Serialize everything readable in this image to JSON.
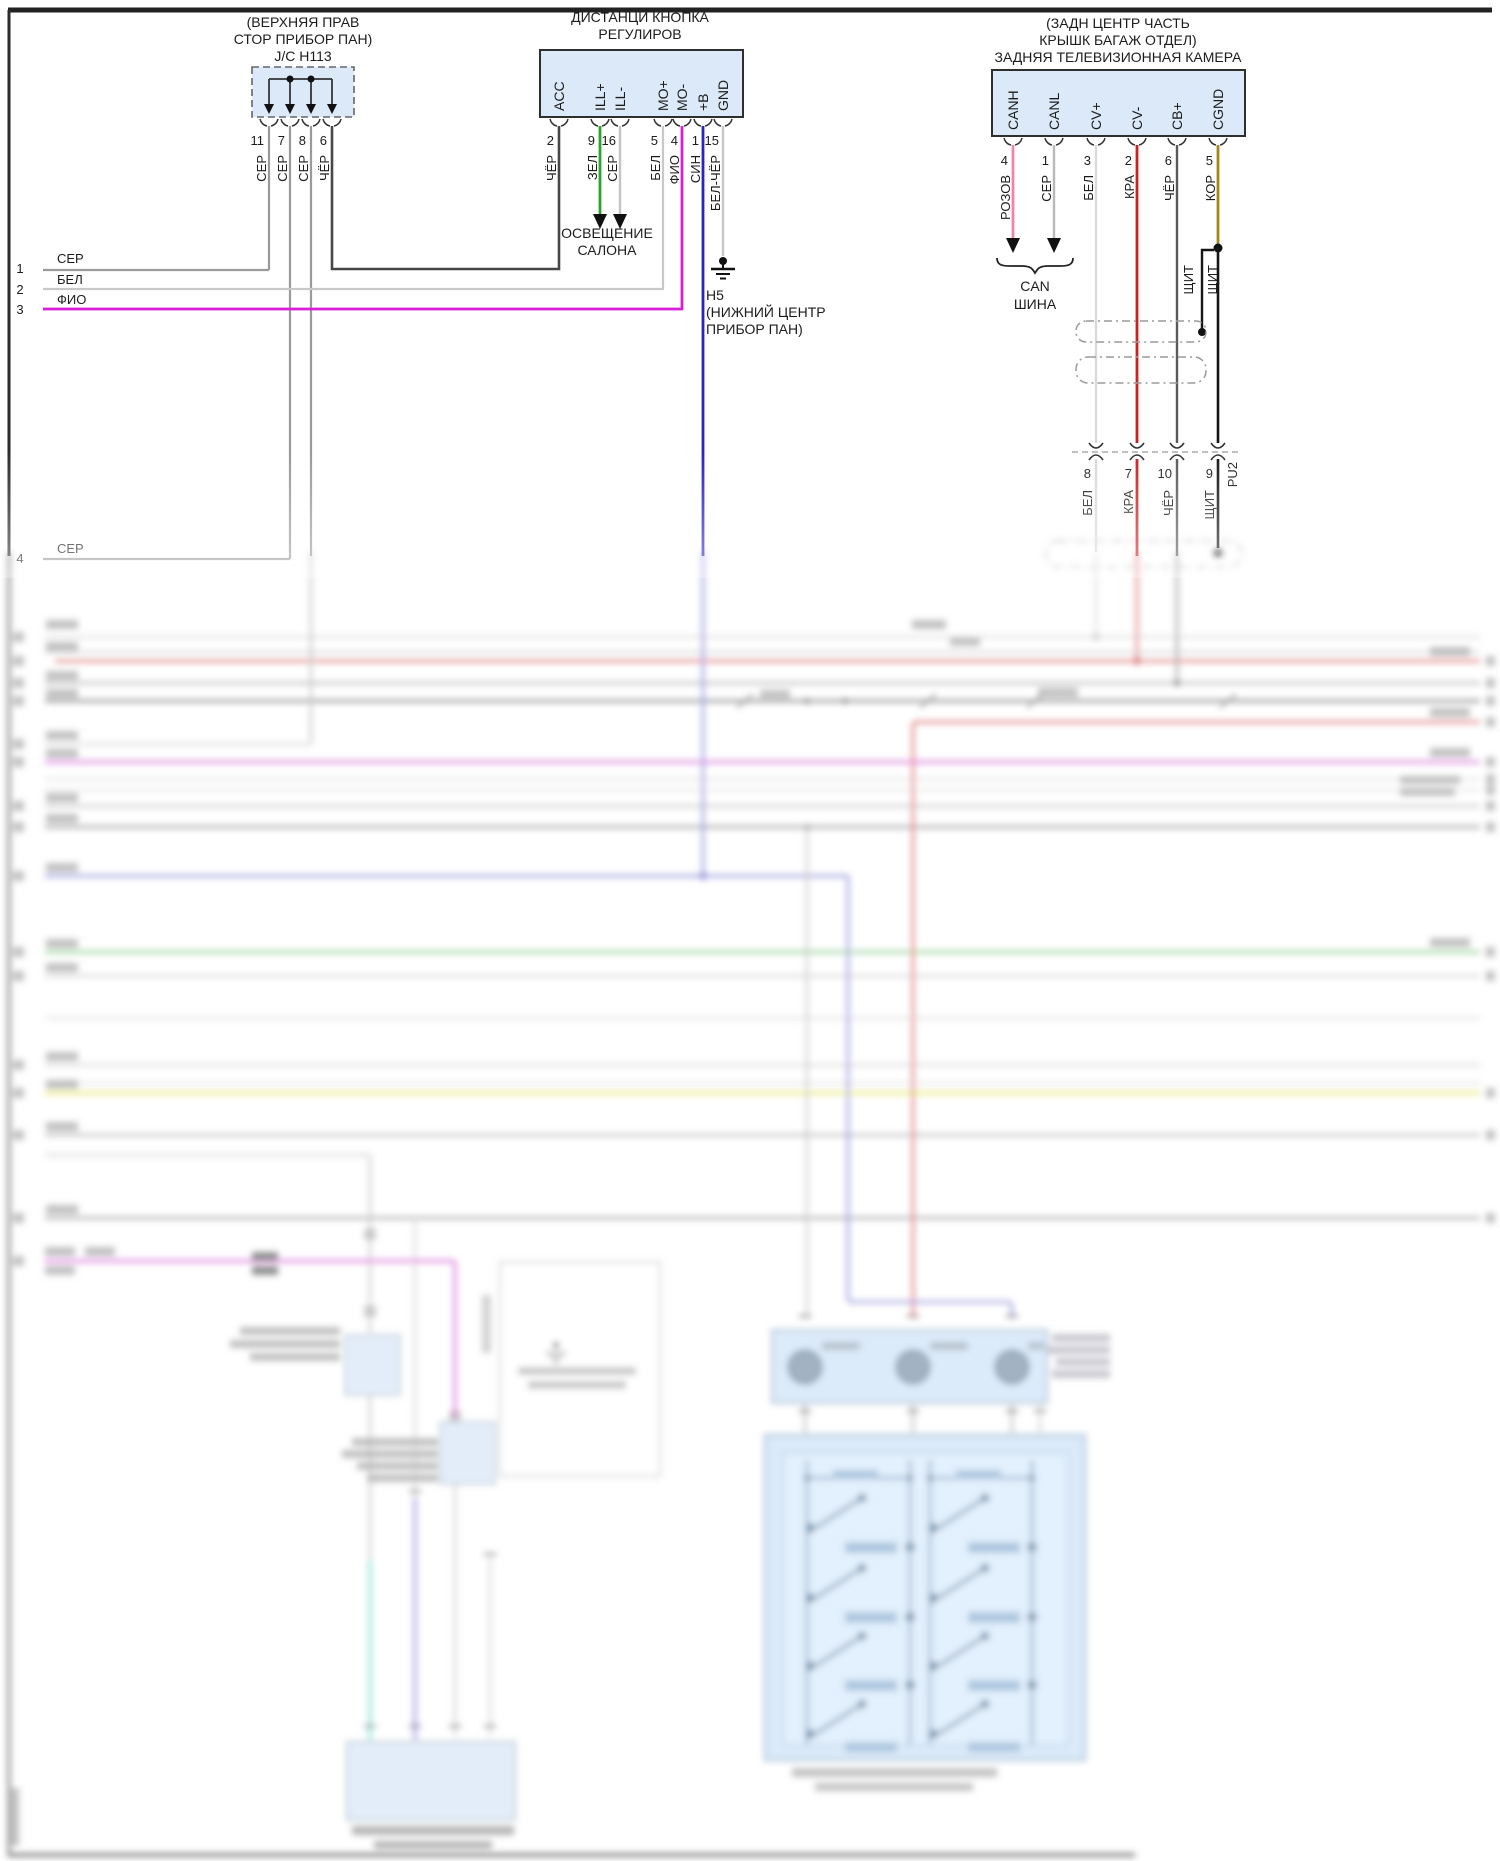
{
  "jc_connector": {
    "title_lines": [
      "(ВЕРХНЯЯ ПРАВ",
      "СТОР ПРИБОР ПАН)",
      "J/C H113"
    ],
    "pins": [
      {
        "num": "11",
        "wire": "СЕР"
      },
      {
        "num": "7",
        "wire": "СЕР"
      },
      {
        "num": "8",
        "wire": "СЕР"
      },
      {
        "num": "6",
        "wire": "ЧЁР"
      }
    ]
  },
  "remote_connector": {
    "title_lines": [
      "ДИСТАНЦИ КНОПКА",
      "РЕГУЛИРОВ"
    ],
    "pins": [
      {
        "name": "ACC",
        "num": "2",
        "wire": "ЧЁР"
      },
      {
        "name": "ILL+",
        "num": "9",
        "wire": "ЗЕЛ"
      },
      {
        "name": "ILL-",
        "num": "16",
        "wire": "СЕР"
      },
      {
        "name": "MO+",
        "num": "5",
        "wire": "БЕЛ"
      },
      {
        "name": "MO-",
        "num": "4",
        "wire": "ФИО"
      },
      {
        "name": "+B",
        "num": "1",
        "wire": "СИН"
      },
      {
        "name": "GND",
        "num": "15",
        "wire": "БЕЛ-ЧЁР"
      }
    ]
  },
  "camera_connector": {
    "title_lines": [
      "(ЗАДН ЦЕНТР ЧАСТЬ",
      "КРЫШК БАГАЖ ОТДЕЛ)",
      "ЗАДНЯЯ ТЕЛЕВИЗИОННАЯ КАМЕРА"
    ],
    "pins": [
      {
        "name": "CANH",
        "num": "4",
        "wire": "РОЗОВ"
      },
      {
        "name": "CANL",
        "num": "1",
        "wire": "СЕР"
      },
      {
        "name": "CV+",
        "num": "3",
        "wire": "БЕЛ"
      },
      {
        "name": "CV-",
        "num": "2",
        "wire": "КРА"
      },
      {
        "name": "CB+",
        "num": "6",
        "wire": "ЧЁР"
      },
      {
        "name": "CGND",
        "num": "5",
        "wire": "КОР"
      }
    ]
  },
  "left_rows": [
    {
      "num": "1",
      "wire": "СЕР"
    },
    {
      "num": "2",
      "wire": "БЕЛ"
    },
    {
      "num": "3",
      "wire": "ФИО"
    },
    {
      "num": "4",
      "wire": "СЕР"
    }
  ],
  "annotations": {
    "interior_light_1": "ОСВЕЩЕНИЕ",
    "interior_light_2": "САЛОНА",
    "ground_name": "H5",
    "ground_loc_1": "(НИЖНИЙ ЦЕНТР",
    "ground_loc_2": "ПРИБОР ПАН)",
    "can_bus_1": "CAN",
    "can_bus_2": "ШИНА",
    "shield_label_1": "ЩИТ",
    "shield_label_2": "ЩИТ"
  },
  "inline_connector": {
    "name": "PU2",
    "pins": [
      {
        "num": "8",
        "wire": "БЕЛ"
      },
      {
        "num": "7",
        "wire": "КРА"
      },
      {
        "num": "10",
        "wire": "ЧЁР"
      },
      {
        "num": "9",
        "wire": "ЩИТ"
      }
    ]
  },
  "wire_colors": {
    "green": "#2fa12f",
    "magenta": "#da1ed8",
    "blue": "#2a23c4",
    "pink": "#ec87a6",
    "red": "#c82323",
    "dark_yellow": "#a3871c",
    "black_wire": "#474747",
    "gray": "#9a9a9a",
    "connector_fill": "#dbe9f8"
  }
}
